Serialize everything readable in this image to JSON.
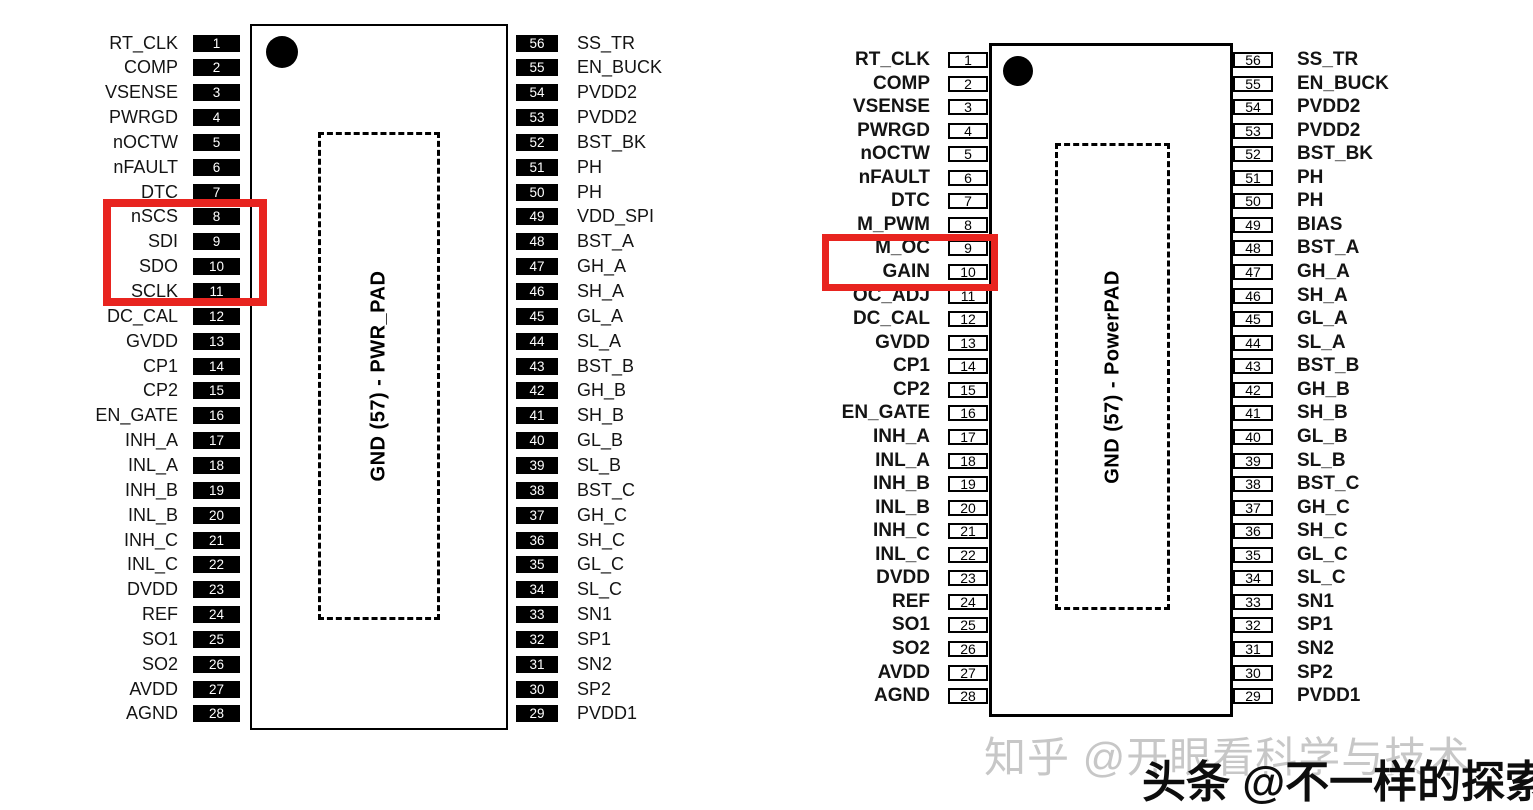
{
  "left_diagram": {
    "pad_label": "GND (57) - PWR_PAD",
    "highlighted_pin_numbers": [
      8,
      9,
      10,
      11
    ],
    "left_pins": [
      {
        "num": "1",
        "label": "RT_CLK"
      },
      {
        "num": "2",
        "label": "COMP"
      },
      {
        "num": "3",
        "label": "VSENSE"
      },
      {
        "num": "4",
        "label": "PWRGD"
      },
      {
        "num": "5",
        "label": "nOCTW"
      },
      {
        "num": "6",
        "label": "nFAULT"
      },
      {
        "num": "7",
        "label": "DTC"
      },
      {
        "num": "8",
        "label": "nSCS"
      },
      {
        "num": "9",
        "label": "SDI"
      },
      {
        "num": "10",
        "label": "SDO"
      },
      {
        "num": "11",
        "label": "SCLK"
      },
      {
        "num": "12",
        "label": "DC_CAL"
      },
      {
        "num": "13",
        "label": "GVDD"
      },
      {
        "num": "14",
        "label": "CP1"
      },
      {
        "num": "15",
        "label": "CP2"
      },
      {
        "num": "16",
        "label": "EN_GATE"
      },
      {
        "num": "17",
        "label": "INH_A"
      },
      {
        "num": "18",
        "label": "INL_A"
      },
      {
        "num": "19",
        "label": "INH_B"
      },
      {
        "num": "20",
        "label": "INL_B"
      },
      {
        "num": "21",
        "label": "INH_C"
      },
      {
        "num": "22",
        "label": "INL_C"
      },
      {
        "num": "23",
        "label": "DVDD"
      },
      {
        "num": "24",
        "label": "REF"
      },
      {
        "num": "25",
        "label": "SO1"
      },
      {
        "num": "26",
        "label": "SO2"
      },
      {
        "num": "27",
        "label": "AVDD"
      },
      {
        "num": "28",
        "label": "AGND"
      }
    ],
    "right_pins": [
      {
        "num": "56",
        "label": "SS_TR"
      },
      {
        "num": "55",
        "label": "EN_BUCK"
      },
      {
        "num": "54",
        "label": "PVDD2"
      },
      {
        "num": "53",
        "label": "PVDD2"
      },
      {
        "num": "52",
        "label": "BST_BK"
      },
      {
        "num": "51",
        "label": "PH"
      },
      {
        "num": "50",
        "label": "PH"
      },
      {
        "num": "49",
        "label": "VDD_SPI"
      },
      {
        "num": "48",
        "label": "BST_A"
      },
      {
        "num": "47",
        "label": "GH_A"
      },
      {
        "num": "46",
        "label": "SH_A"
      },
      {
        "num": "45",
        "label": "GL_A"
      },
      {
        "num": "44",
        "label": "SL_A"
      },
      {
        "num": "43",
        "label": "BST_B"
      },
      {
        "num": "42",
        "label": "GH_B"
      },
      {
        "num": "41",
        "label": "SH_B"
      },
      {
        "num": "40",
        "label": "GL_B"
      },
      {
        "num": "39",
        "label": "SL_B"
      },
      {
        "num": "38",
        "label": "BST_C"
      },
      {
        "num": "37",
        "label": "GH_C"
      },
      {
        "num": "36",
        "label": "SH_C"
      },
      {
        "num": "35",
        "label": "GL_C"
      },
      {
        "num": "34",
        "label": "SL_C"
      },
      {
        "num": "33",
        "label": "SN1"
      },
      {
        "num": "32",
        "label": "SP1"
      },
      {
        "num": "31",
        "label": "SN2"
      },
      {
        "num": "30",
        "label": "SP2"
      },
      {
        "num": "29",
        "label": "PVDD1"
      }
    ]
  },
  "right_diagram": {
    "pad_label": "GND (57) - PowerPAD",
    "highlighted_pin_numbers": [
      9,
      10
    ],
    "left_pins": [
      {
        "num": "1",
        "label": "RT_CLK"
      },
      {
        "num": "2",
        "label": "COMP"
      },
      {
        "num": "3",
        "label": "VSENSE"
      },
      {
        "num": "4",
        "label": "PWRGD"
      },
      {
        "num": "5",
        "label": "nOCTW"
      },
      {
        "num": "6",
        "label": "nFAULT"
      },
      {
        "num": "7",
        "label": "DTC"
      },
      {
        "num": "8",
        "label": "M_PWM"
      },
      {
        "num": "9",
        "label": "M_OC"
      },
      {
        "num": "10",
        "label": "GAIN"
      },
      {
        "num": "11",
        "label": "OC_ADJ"
      },
      {
        "num": "12",
        "label": "DC_CAL"
      },
      {
        "num": "13",
        "label": "GVDD"
      },
      {
        "num": "14",
        "label": "CP1"
      },
      {
        "num": "15",
        "label": "CP2"
      },
      {
        "num": "16",
        "label": "EN_GATE"
      },
      {
        "num": "17",
        "label": "INH_A"
      },
      {
        "num": "18",
        "label": "INL_A"
      },
      {
        "num": "19",
        "label": "INH_B"
      },
      {
        "num": "20",
        "label": "INL_B"
      },
      {
        "num": "21",
        "label": "INH_C"
      },
      {
        "num": "22",
        "label": "INL_C"
      },
      {
        "num": "23",
        "label": "DVDD"
      },
      {
        "num": "24",
        "label": "REF"
      },
      {
        "num": "25",
        "label": "SO1"
      },
      {
        "num": "26",
        "label": "SO2"
      },
      {
        "num": "27",
        "label": "AVDD"
      },
      {
        "num": "28",
        "label": "AGND"
      }
    ],
    "right_pins": [
      {
        "num": "56",
        "label": "SS_TR"
      },
      {
        "num": "55",
        "label": "EN_BUCK"
      },
      {
        "num": "54",
        "label": "PVDD2"
      },
      {
        "num": "53",
        "label": "PVDD2"
      },
      {
        "num": "52",
        "label": "BST_BK"
      },
      {
        "num": "51",
        "label": "PH"
      },
      {
        "num": "50",
        "label": "PH"
      },
      {
        "num": "49",
        "label": "BIAS"
      },
      {
        "num": "48",
        "label": "BST_A"
      },
      {
        "num": "47",
        "label": "GH_A"
      },
      {
        "num": "46",
        "label": "SH_A"
      },
      {
        "num": "45",
        "label": "GL_A"
      },
      {
        "num": "44",
        "label": "SL_A"
      },
      {
        "num": "43",
        "label": "BST_B"
      },
      {
        "num": "42",
        "label": "GH_B"
      },
      {
        "num": "41",
        "label": "SH_B"
      },
      {
        "num": "40",
        "label": "GL_B"
      },
      {
        "num": "39",
        "label": "SL_B"
      },
      {
        "num": "38",
        "label": "BST_C"
      },
      {
        "num": "37",
        "label": "GH_C"
      },
      {
        "num": "36",
        "label": "SH_C"
      },
      {
        "num": "35",
        "label": "GL_C"
      },
      {
        "num": "34",
        "label": "SL_C"
      },
      {
        "num": "33",
        "label": "SN1"
      },
      {
        "num": "32",
        "label": "SP1"
      },
      {
        "num": "31",
        "label": "SN2"
      },
      {
        "num": "30",
        "label": "SP2"
      },
      {
        "num": "29",
        "label": "PVDD1"
      }
    ]
  },
  "watermarks": {
    "zhihu": "知乎 @开眼看科学与技术",
    "toutiao": "头条 @不一样的探索"
  },
  "colors": {
    "highlight_red": "#e8241f",
    "pin_box_fill_left_diagram": "#000000",
    "watermark_gray": "#c7c7c7",
    "watermark_black": "#0d0d0d"
  }
}
